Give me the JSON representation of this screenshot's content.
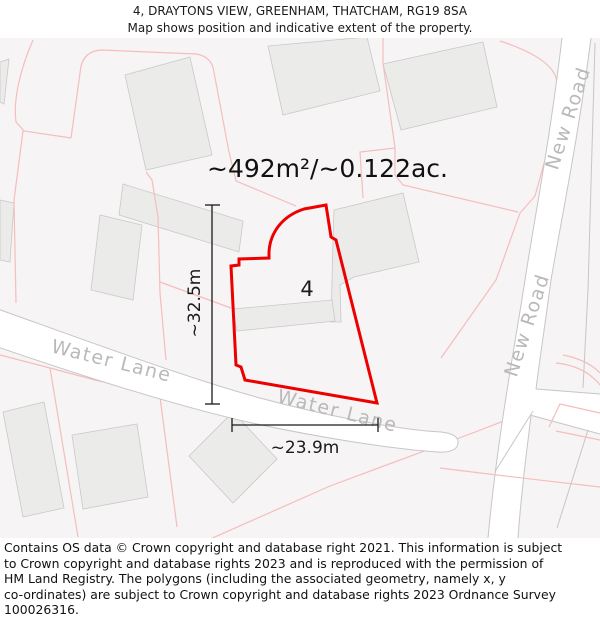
{
  "title": {
    "line1": "4, DRAYTONS VIEW, GREENHAM, THATCHAM, RG19 8SA",
    "line2": "Map shows position and indicative extent of the property."
  },
  "map": {
    "area_label": "~492m²/~0.122ac.",
    "plot_number": "4",
    "dimensions": {
      "vertical": "~32.5m",
      "horizontal": "~23.9m"
    },
    "road_labels": [
      {
        "text": "Water Lane"
      },
      {
        "text": "Water Lane"
      },
      {
        "text": "New Road"
      },
      {
        "text": "New Road"
      }
    ],
    "colors": {
      "property_outline": "#ec0000",
      "parcel_line": "#f5bdbd",
      "building_fill": "#ebebea",
      "building_edge": "#c9c9c9",
      "road_edge": "#c6c6c6",
      "label_gray": "#b9b9b9",
      "map_background": "#f6f4f4",
      "dimension_line": "#1a1a1a"
    }
  },
  "footer": {
    "lines": [
      "Contains OS data © Crown copyright and database right 2021. This information is subject",
      "to Crown copyright and database rights 2023 and is reproduced with the permission of",
      "HM Land Registry. The polygons (including the associated geometry, namely x, y",
      "co-ordinates) are subject to Crown copyright and database rights 2023 Ordnance Survey",
      "100026316."
    ]
  }
}
